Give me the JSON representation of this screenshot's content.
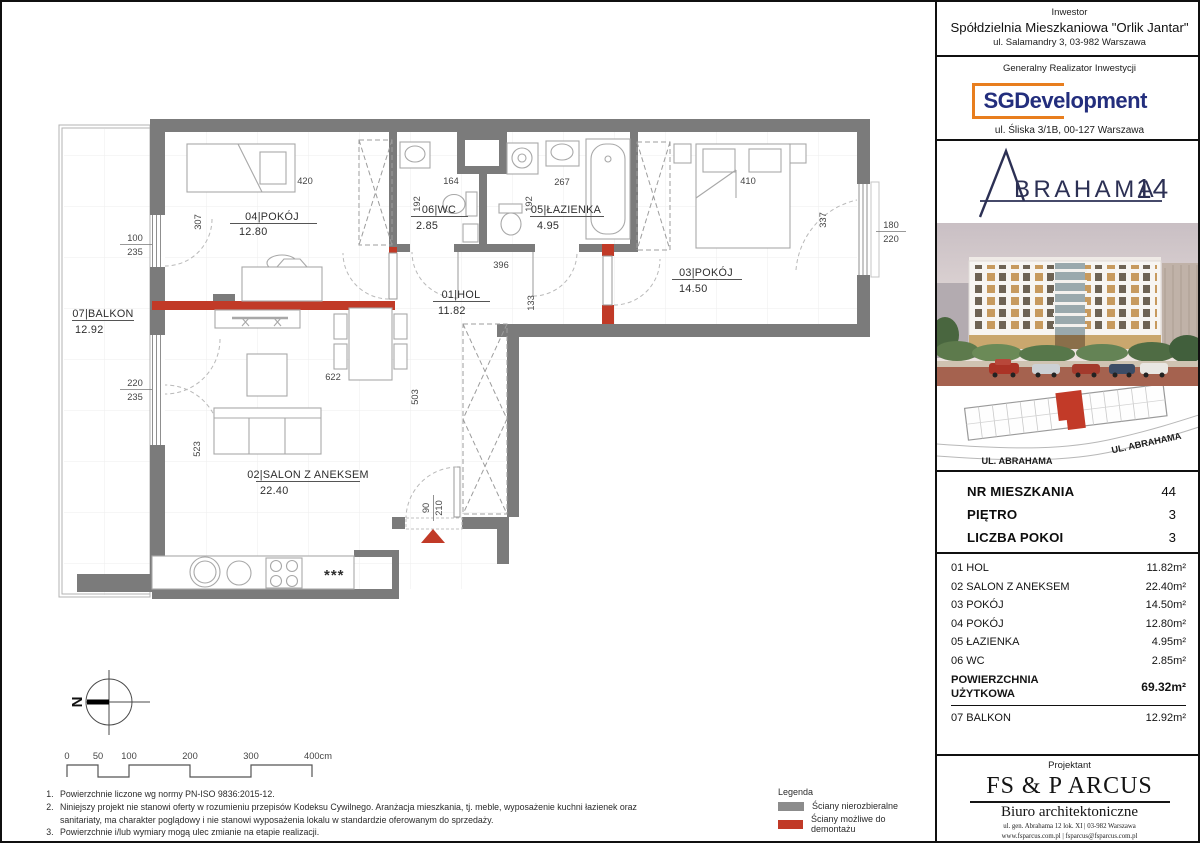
{
  "sidebar": {
    "investor": {
      "heading": "Inwestor",
      "name": "Spółdzielnia Mieszkaniowa \"Orlik Jantar\"",
      "address": "ul. Salamandry 3, 03-982 Warszawa"
    },
    "contractor": {
      "heading": "Generalny Realizator Inwestycji",
      "logo_text": "SGDevelopment",
      "address": "ul. Śliska 3/1B, 00-127 Warszawa"
    },
    "brand": {
      "rest": "BRAHAMA",
      "number": "14"
    },
    "siteplan": {
      "street_left": "UL. ABRAHAMA",
      "street_right": "UL. ABRAHAMA"
    },
    "unit_info": {
      "rows": [
        {
          "label": "NR MIESZKANIA",
          "value": "44"
        },
        {
          "label": "PIĘTRO",
          "value": "3"
        },
        {
          "label": "LICZBA POKOI",
          "value": "3"
        }
      ]
    },
    "rooms_table": {
      "rows": [
        {
          "label": "01 HOL",
          "area": "11.82m²"
        },
        {
          "label": "02 SALON Z ANEKSEM",
          "area": "22.40m²"
        },
        {
          "label": "03 POKÓJ",
          "area": "14.50m²"
        },
        {
          "label": "04 POKÓJ",
          "area": "12.80m²"
        },
        {
          "label": "05 ŁAZIENKA",
          "area": "4.95m²"
        },
        {
          "label": "06 WC",
          "area": "2.85m²"
        }
      ],
      "total_label_1": "POWIERZCHNIA",
      "total_label_2": "UŻYTKOWA",
      "total_value": "69.32m²",
      "balcony_label": "07 BALKON",
      "balcony_area": "12.92m²"
    },
    "designer": {
      "heading": "Projektant",
      "name": "FS & P ARCUS",
      "subtitle": "Biuro architektoniczne",
      "line1": "ul. gen. Abrahama 12 lok. XI | 03-982 Warszawa",
      "line2": "www.fsparcus.com.pl | fsparcus@fsparcus.com.pl"
    }
  },
  "plan": {
    "rooms": {
      "r01": {
        "label": "01|HOL",
        "area": "11.82"
      },
      "r02": {
        "label": "02|SALON Z ANEKSEM",
        "area": "22.40"
      },
      "r03": {
        "label": "03|POKÓJ",
        "area": "14.50"
      },
      "r04": {
        "label": "04|POKÓJ",
        "area": "12.80"
      },
      "r05": {
        "label": "05|ŁAZIENKA",
        "area": "4.95"
      },
      "r06": {
        "label": "06|WC",
        "area": "2.85"
      },
      "r07": {
        "label": "07|BALKON",
        "area": "12.92"
      }
    },
    "dims": {
      "d420": "420",
      "d307": "307",
      "d164": "164",
      "d192wc": "192",
      "d267": "267",
      "d192laz": "192",
      "d410": "410",
      "d337": "337",
      "d396": "396",
      "d133": "133",
      "d622": "622",
      "d503": "503",
      "d523": "523",
      "d90": "90",
      "d210": "210",
      "w1top": "100",
      "w1bot": "235",
      "w2top": "220",
      "w2bot": "235",
      "w3top": "180",
      "w3bot": "220"
    },
    "stars": "***",
    "compass": "N"
  },
  "scalebar": {
    "labels": [
      "0",
      "50",
      "100",
      "200",
      "300",
      "400cm"
    ]
  },
  "legend": {
    "title": "Legenda",
    "items": [
      {
        "label": "Ściany nierozbieralne",
        "color": "#8c8c8c"
      },
      {
        "label": "Ściany możliwe do demontażu",
        "color": "#c13a27"
      }
    ]
  },
  "notes": [
    "Powierzchnie liczone wg normy PN-ISO 9836:2015-12.",
    "Niniejszy projekt nie stanowi oferty w rozumieniu przepisów Kodeksu Cywilnego. Aranżacja mieszkania, tj. meble, wyposażenie  kuchni łazienek oraz sanitariaty, ma charakter poglądowy i nie stanowi wyposażenia lokalu w standardzie oferowanym do sprzedaży.",
    "Powierzchnie i/lub wymiary mogą ulec zmianie na etapie realizacji.",
    "Wyjście na tarasy/loggie/balkony - możliwa różnica poziomów."
  ],
  "colors": {
    "wall_gray": "#7b7b7b",
    "wall_red": "#c13a27",
    "brand_navy": "#2c3054",
    "sg_navy": "#232e7d",
    "sg_orange": "#e87e1e"
  }
}
